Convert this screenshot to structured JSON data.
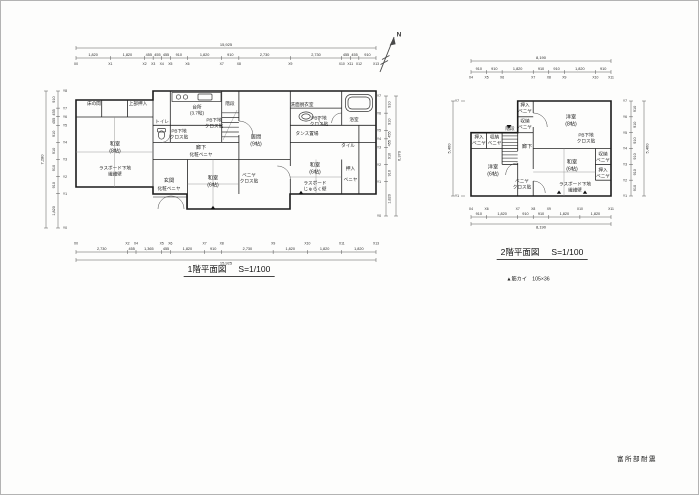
{
  "sheet": {
    "north_label": "N",
    "stamp": "富所部耐震",
    "brace_note": "▲筋カイ　105×36"
  },
  "floor1": {
    "caption": "1階平面図",
    "scale": "S=1/100",
    "rooms": {
      "tokonoma": "床の間",
      "oshiire_upper": "上部押入",
      "washitsu8": "和室\n(8帖)",
      "washitsu8_note": "ラスボード下地\n繊維壁",
      "toilet": "トイレ",
      "toilet_note": "PB下地\nクロス貼",
      "kitchen": "台所\n(3.7帖)",
      "kitchen_note": "PB下地\nクロス貼",
      "stairs": "階段",
      "hall": "廊下",
      "hall_note": "化粧ベニヤ",
      "genkan": "玄関",
      "genkan_note": "化粧ベニヤ",
      "washitsu6c": "和室\n(6帖)",
      "ima": "居間\n(9帖)",
      "ima_note": "ベニヤ\nクロス貼",
      "senmen": "洗面脱衣室",
      "senmen_note": "PB下地\nクロス貼",
      "bath": "浴室",
      "tile": "タイル",
      "tansu": "タンス置場",
      "washitsu6r": "和室\n(6帖)",
      "washitsu6r_note": "ラスボード\nじゅらく壁",
      "oshiire_r": "押入",
      "oshiire_r_note": "ベニヤ"
    },
    "dims": {
      "top": {
        "total": "15,925",
        "values": [
          "1,820",
          "1,820",
          "455",
          "455",
          "455",
          "910",
          "1,820",
          "910",
          "2,730",
          "2,730",
          "455",
          "455",
          "910"
        ],
        "grids": [
          "X0",
          "X1",
          "X2",
          "X3",
          "X4",
          "X5",
          "X6",
          "X7",
          "X8",
          "X9",
          "X10",
          "X11",
          "X12",
          "X13"
        ]
      },
      "bottom": {
        "total": "15,925",
        "values": [
          "2,730",
          "455",
          "1,365",
          "455",
          "1,820",
          "910",
          "2,730",
          "1,820",
          "1,820",
          "1,820"
        ],
        "grids": [
          "X0",
          "X2",
          "X4",
          "X5",
          "X6",
          "X7",
          "X8",
          "X9",
          "X10",
          "X11",
          "X13"
        ]
      },
      "left": {
        "total": "7,280",
        "values": [
          "910",
          "455",
          "455",
          "910",
          "910",
          "910",
          "910",
          "1,820"
        ],
        "grids": [
          "Y8",
          "Y7",
          "Y6",
          "Y5",
          "Y4",
          "Y3",
          "Y2",
          "Y1",
          "Y0"
        ]
      },
      "right": {
        "total": "6,370",
        "values": [
          "910",
          "910",
          "455",
          "455",
          "910",
          "910",
          "1,820"
        ],
        "grids": [
          "Y7",
          "Y6",
          "Y5",
          "Y4",
          "Y3",
          "Y2",
          "Y1",
          "Y0"
        ]
      }
    }
  },
  "floor2": {
    "caption": "2階平面図",
    "scale": "S=1/100",
    "rooms": {
      "oshiire_top": "押入\nベニヤ",
      "shuno_top": "収納\nベニヤ",
      "yoshitsu8": "洋室\n(8帖)",
      "yoshitsu8_note": "PB下地\nクロス貼",
      "oshiire_left": "押入\nベニヤ",
      "shuno_left": "収納\nベニヤ",
      "stairs": "階段",
      "hall": "廊下",
      "yoshitsu6": "洋室\n(6帖)",
      "yoshitsu6_note": "ベニヤ\nクロス貼",
      "washitsu6": "和室\n(6帖)",
      "washitsu6_note": "ラスボード下地\n繊維壁",
      "shuno_right": "収納\nベニヤ",
      "oshiire_right": "押入\nベニヤ"
    },
    "dims": {
      "top": {
        "total": "8,190",
        "values": [
          "910",
          "910",
          "1,820",
          "910",
          "910",
          "1,820",
          "910"
        ],
        "grids": [
          "X4",
          "X5",
          "X6",
          "X7",
          "X8",
          "X9",
          "X10",
          "X11"
        ]
      },
      "bottom": {
        "total": "8,190",
        "values": [
          "910",
          "1,820",
          "910",
          "910",
          "1,820",
          "1,820"
        ],
        "grids": [
          "X4",
          "X6",
          "X7",
          "X8",
          "X9",
          "X10",
          "X11"
        ]
      },
      "left": {
        "total": "5,460",
        "values": [],
        "grids": [
          "Y7",
          "Y1"
        ]
      },
      "right": {
        "total": "5,460",
        "values": [
          "910",
          "910",
          "910",
          "910",
          "910",
          "910"
        ],
        "grids": [
          "Y7",
          "Y6",
          "Y5",
          "Y4",
          "Y3",
          "Y2",
          "Y1"
        ]
      }
    }
  }
}
